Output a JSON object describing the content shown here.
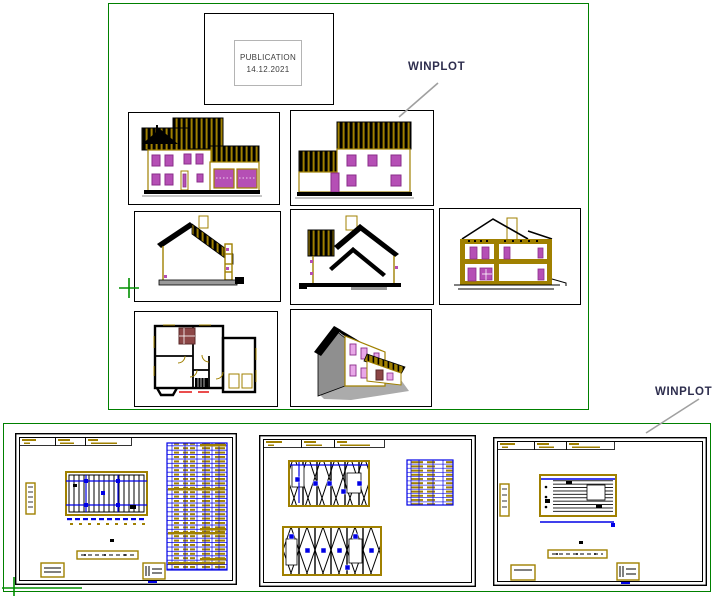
{
  "publication": {
    "title": "PUBLICATION",
    "date": "14.12.2021"
  },
  "labels": {
    "winplot": "WINPLOT"
  },
  "colors": {
    "frame_green": "#008000",
    "accent_olive": "#A08000",
    "drawing_blue": "#0000E6",
    "window_purple": "#8A2E8A",
    "window_fill": "#B54FB5",
    "leader_gray": "#A0A0A0",
    "label_navy": "#2E2E4E"
  },
  "preview": {
    "drawings": [
      "front-elevation",
      "rear-elevation",
      "cross-section-left",
      "cross-section-middle",
      "cross-section-right",
      "ground-floor-plan",
      "house-3d-view"
    ]
  },
  "sheets": [
    "framing-plan-sheet",
    "wall-truss-panel-sheet",
    "cladding-panel-sheet"
  ]
}
